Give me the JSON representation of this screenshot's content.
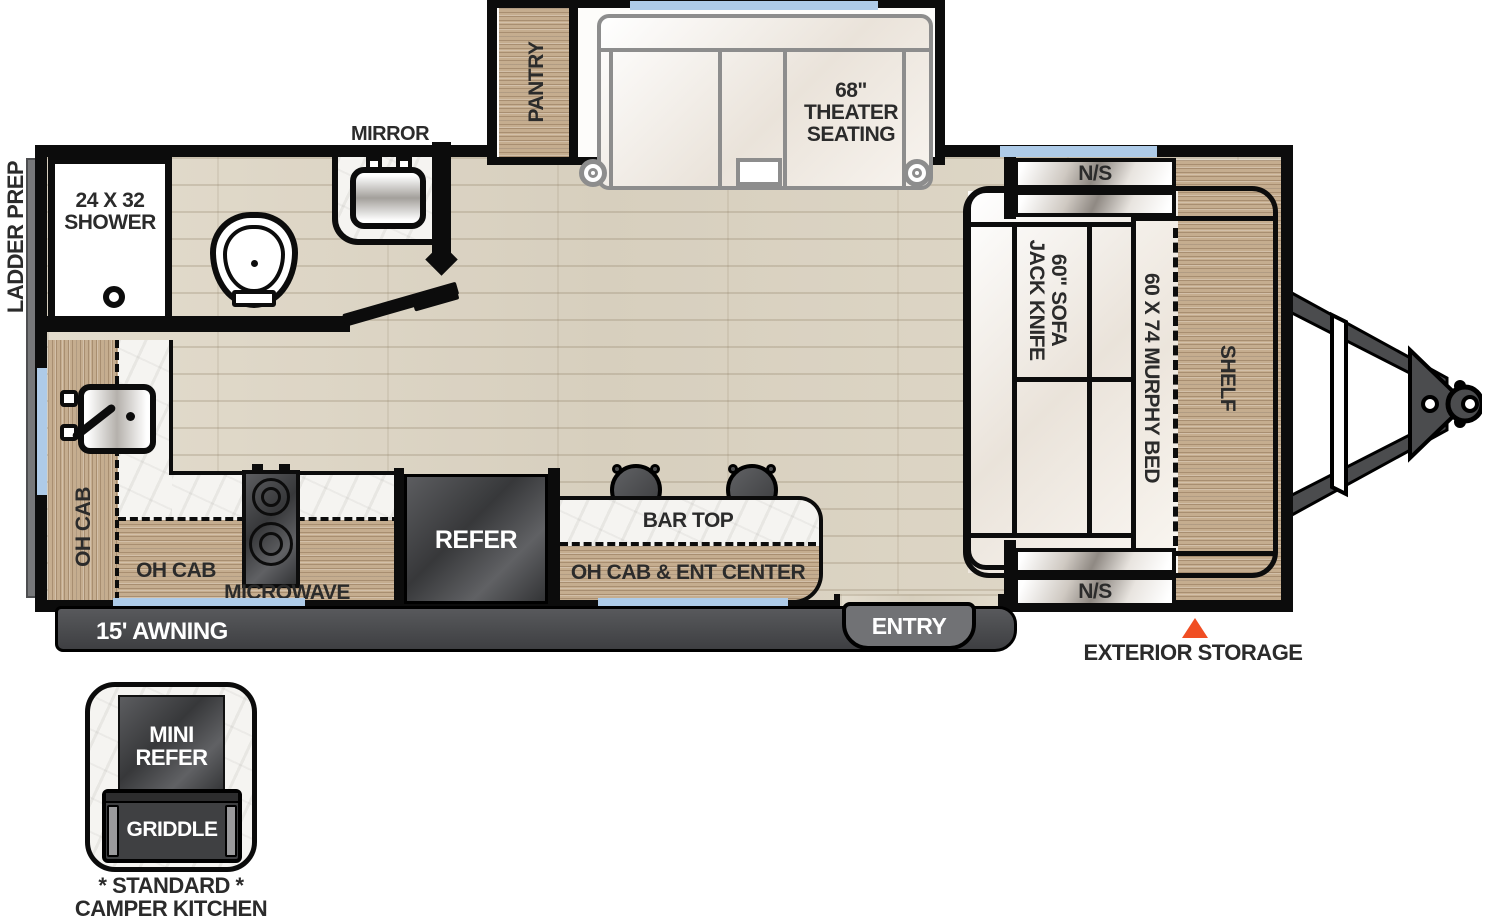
{
  "colors": {
    "wall": "#0c0c0c",
    "window_blue": "#aecbe8",
    "appliance_gray": "#4a4b4d",
    "cabinet_wood": "#c5ad8f",
    "floor_wood": "#ddd6c6",
    "counter_marble": "#f5f4f1",
    "accent_orange": "#f04e23"
  },
  "exterior": {
    "ladder_prep": "LADDER PREP",
    "awning": "15' AWNING",
    "entry": "ENTRY",
    "exterior_storage": "EXTERIOR STORAGE"
  },
  "bathroom": {
    "mirror": "MIRROR",
    "shower": "24 X 32\nSHOWER"
  },
  "living": {
    "pantry": "PANTRY",
    "theater_seating": "68\"\nTHEATER\nSEATING"
  },
  "kitchen": {
    "oh_cab_left": "OH CAB",
    "oh_cab_bottom": "OH CAB",
    "microwave": "MICROWAVE",
    "refer": "REFER",
    "bar_top": "BAR TOP",
    "oh_cab_ent_center": "OH CAB & ENT CENTER"
  },
  "bedroom": {
    "ns_rear": "N/S",
    "ns_front": "N/S",
    "sofa": "60\" SOFA\nJACK KNIFE",
    "murphy_bed": "60 X 74 MURPHY BED",
    "shelf": "SHELF"
  },
  "camper_kitchen": {
    "mini_refer": "MINI\nREFER",
    "griddle": "GRIDDLE",
    "caption": "* STANDARD *\nCAMPER KITCHEN"
  }
}
